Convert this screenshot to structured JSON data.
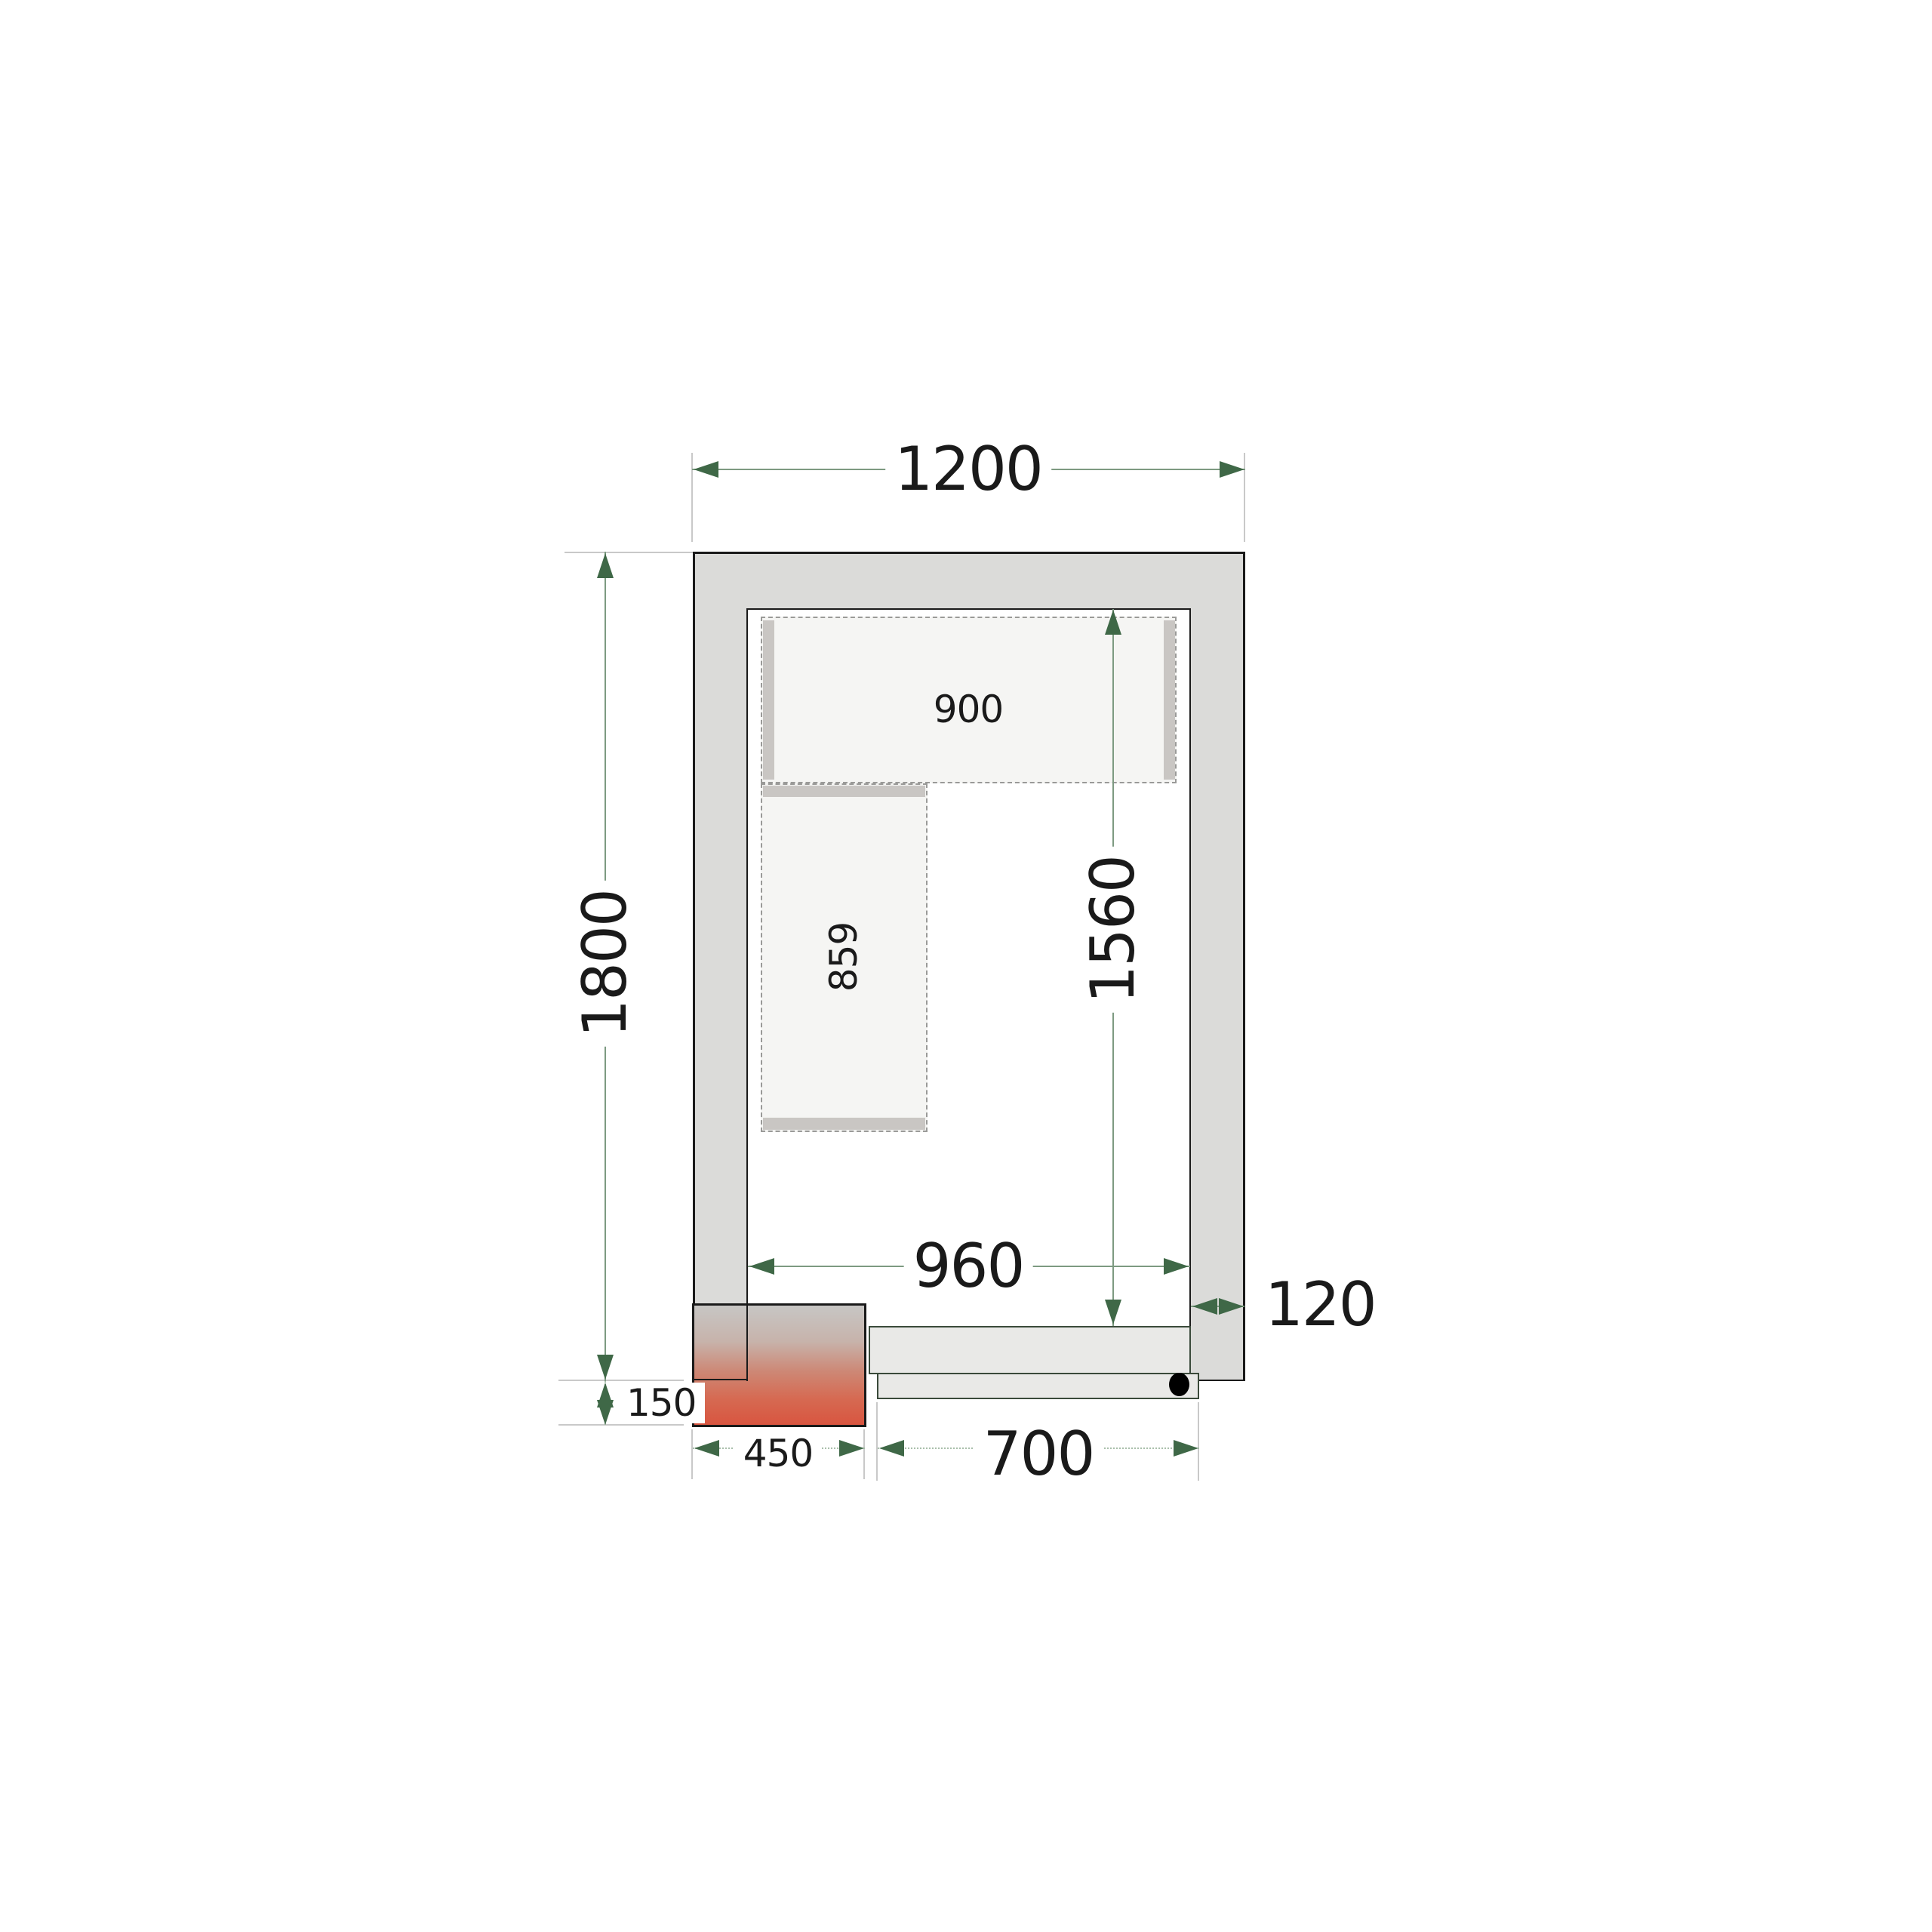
{
  "drawing": {
    "type": "cold-room-floor-plan-top-view",
    "dimensions": {
      "exterior_width": "1200",
      "exterior_depth": "1800",
      "interior_width": "960",
      "interior_depth": "1560",
      "wall_thickness": "120",
      "door_width": "700",
      "cooling_unit_width": "450",
      "cooling_unit_protrusion": "150"
    },
    "shelves": {
      "top_shelf_length": "900",
      "left_shelf_length": "859"
    },
    "colors": {
      "wall_fill": "#dbdbd9",
      "shelf_fill": "#f5f5f3",
      "shelf_support": "#c9c6c3",
      "door_fill": "#e9e9e7",
      "unit_red": "#d85540",
      "dimension_line": "#7d9a81",
      "arrow_green": "#3f6847",
      "extension_line": "#c9c9c9",
      "text": "#1a1a1a"
    }
  }
}
